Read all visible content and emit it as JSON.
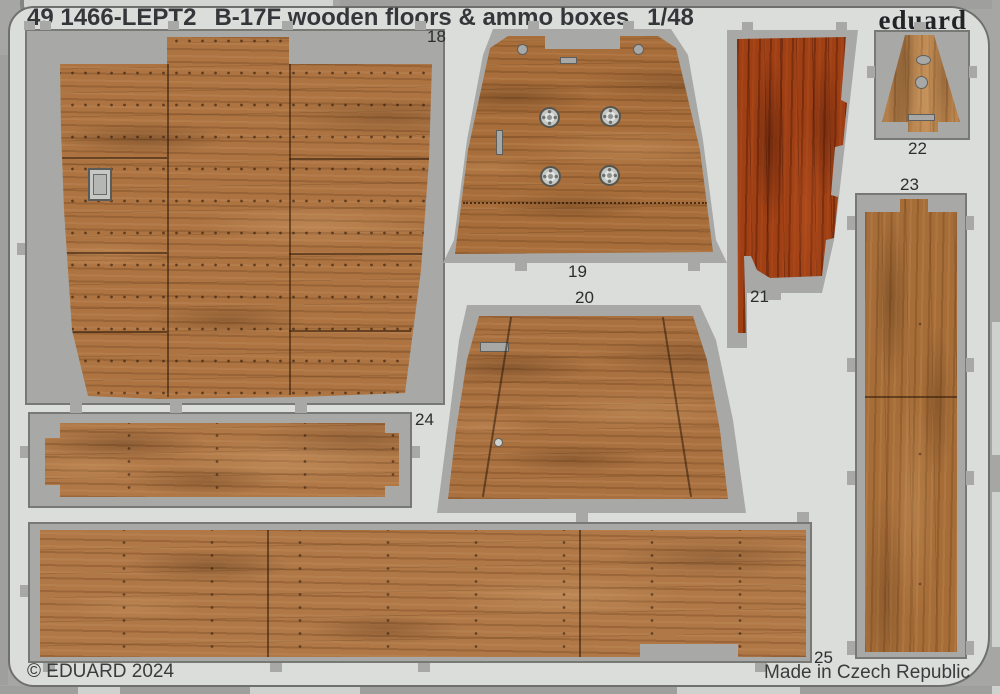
{
  "header": {
    "catalog_code": "49 1466-LEPT2",
    "title": "B-17F wooden floors & ammo boxes",
    "scale": "1/48",
    "brand": "eduard"
  },
  "footer": {
    "copyright": "© EDUARD 2024",
    "made_in": "Made in Czech Republic"
  },
  "parts": [
    {
      "number": "18"
    },
    {
      "number": "19"
    },
    {
      "number": "20"
    },
    {
      "number": "21"
    },
    {
      "number": "22"
    },
    {
      "number": "23"
    },
    {
      "number": "24"
    },
    {
      "number": "25"
    }
  ],
  "colors": {
    "bg-gray": "#a6a7a4",
    "sheet-gray": "#dbddda",
    "cutout-gray": "#a8a9a6",
    "line-gray": "#6f706d",
    "ink": "#35363a",
    "wood-mid": "#ab713d",
    "wood-light": "#c08a52",
    "wood-red": "#9e3f14"
  }
}
